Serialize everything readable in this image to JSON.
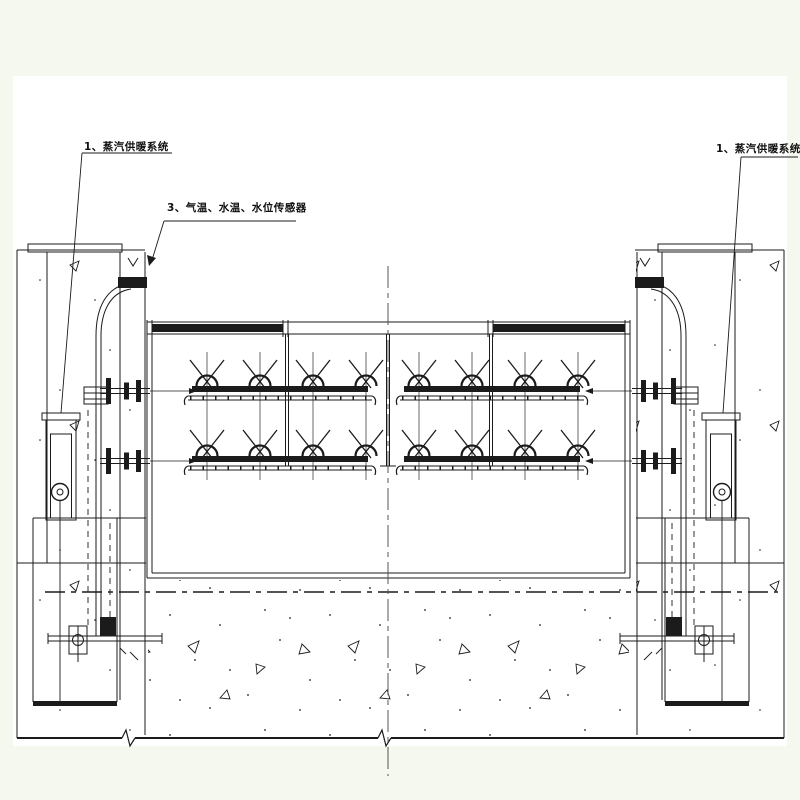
{
  "page": {
    "background": "#f4f8ef",
    "paper": "#ffffff",
    "ink": "#1b1b1b",
    "centerline_color": "#555555"
  },
  "callouts": {
    "steam_left": "1、蒸汽供暖系统",
    "sensors": "3、气温、水温、水位传感器",
    "steam_right": "1、蒸汽供暖系统"
  },
  "drawing": {
    "type": "technical_section_diagram",
    "heater_groups": 2,
    "heater_rows_per_group": 2,
    "heaters_per_row": 4
  }
}
